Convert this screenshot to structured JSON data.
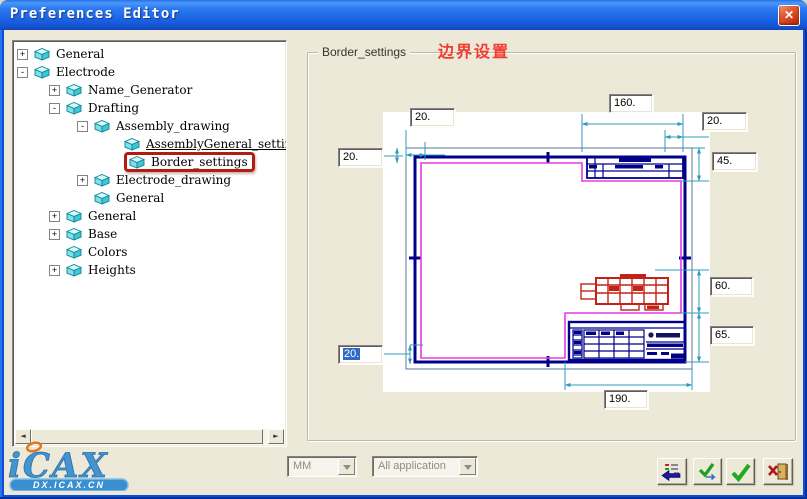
{
  "window": {
    "title": "Preferences Editor"
  },
  "tree": {
    "items": [
      {
        "label": "General",
        "level": 0,
        "expander": "+"
      },
      {
        "label": "Electrode",
        "level": 0,
        "expander": "-"
      },
      {
        "label": "Name_Generator",
        "level": 1,
        "expander": "+"
      },
      {
        "label": "Drafting",
        "level": 1,
        "expander": "-"
      },
      {
        "label": "Assembly_drawing",
        "level": 2,
        "expander": "-"
      },
      {
        "label": "AssemblyGeneral_settings",
        "level": 3,
        "expander": "",
        "underlined": true
      },
      {
        "label": "Border_settings",
        "level": 3,
        "expander": "",
        "highlighted": true
      },
      {
        "label": "Electrode_drawing",
        "level": 2,
        "expander": "+"
      },
      {
        "label": "General",
        "level": 2,
        "expander": ""
      },
      {
        "label": "General",
        "level": 1,
        "expander": "+"
      },
      {
        "label": "Base",
        "level": 1,
        "expander": "+"
      },
      {
        "label": "Colors",
        "level": 1,
        "expander": ""
      },
      {
        "label": "Heights",
        "level": 1,
        "expander": "+"
      }
    ]
  },
  "panel": {
    "group_label": "Border_settings",
    "annotation": "边界设置",
    "dims": {
      "top_left": "20.",
      "top_center": "160.",
      "top_right": "20.",
      "left": "20.",
      "right_top": "45.",
      "right_mid": "60.",
      "right_bottom": "65.",
      "bottom_left": "20.",
      "bottom_center": "190."
    }
  },
  "footer": {
    "unit_combo_value": "MM",
    "scope_combo_value": "All application",
    "buttons": [
      {
        "name": "reset-defaults",
        "icon": "list-with-back-arrow-icon"
      },
      {
        "name": "apply",
        "icon": "check-with-arrows-icon"
      },
      {
        "name": "ok",
        "icon": "green-check-icon"
      },
      {
        "name": "exit",
        "icon": "door-with-x-icon"
      }
    ]
  },
  "logo": {
    "text": "iCAX",
    "banner": "DX.ICAX.CN"
  },
  "scrollbar": {
    "left_arrow": "◄",
    "right_arrow": "►"
  },
  "colors": {
    "titlebar_blue": "#1a5fe0",
    "client_beige": "#ece9d8",
    "highlight_red": "#b21d12",
    "annotation_red": "#f23c30",
    "border_navy": "#00008b",
    "margin_magenta": "#e83ae8",
    "dimension_cyan": "#2e9bbf",
    "table_red": "#c42218",
    "selection_blue": "#316ac5"
  }
}
